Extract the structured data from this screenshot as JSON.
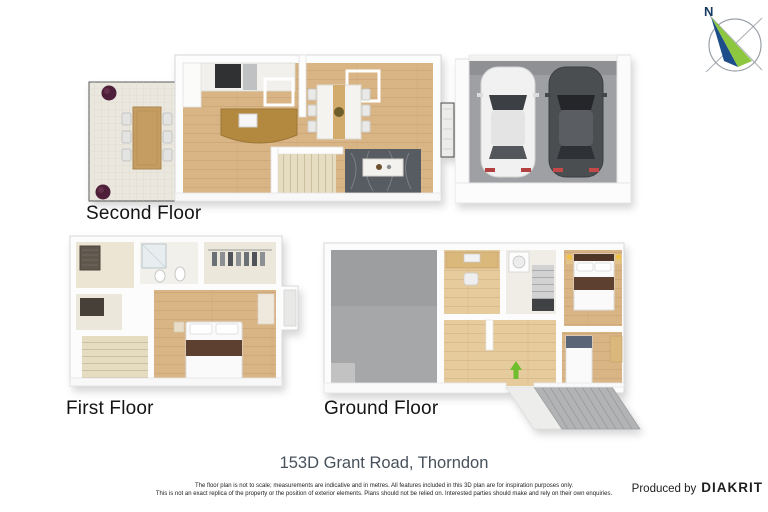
{
  "compass": {
    "label": "N"
  },
  "floors": [
    {
      "label": "Second Floor"
    },
    {
      "label": "First Floor"
    },
    {
      "label": "Ground Floor"
    }
  ],
  "footer": {
    "address": "153D Grant Road, Thorndon",
    "disclaimer_line1": "The floor plan is not to scale; measurements are indicative and in metres. All features included in this 3D plan are for inspiration purposes only.",
    "disclaimer_line2": "This is not an exact replica of the property or the position of exterior elements. Plans should not be relied on. Interested parties should make and rely on their own enquiries.",
    "producer_prefix": "Produced by",
    "producer_brand": "DIAKRIT"
  },
  "colors": {
    "wood_floor": "#d9b586",
    "light_wood_floor": "#e6cb9d",
    "deck_tile": "#eae7de",
    "garage_floor": "#9ea0a3",
    "rug": "#575c62",
    "kitchen_island": "#b3893f",
    "bed_runner": "#5d4030",
    "entry_arrow_green": "#6fbe2e",
    "compass_green": "#8dc63f",
    "compass_navy": "#1d4e89",
    "address_text": "#47515b"
  }
}
